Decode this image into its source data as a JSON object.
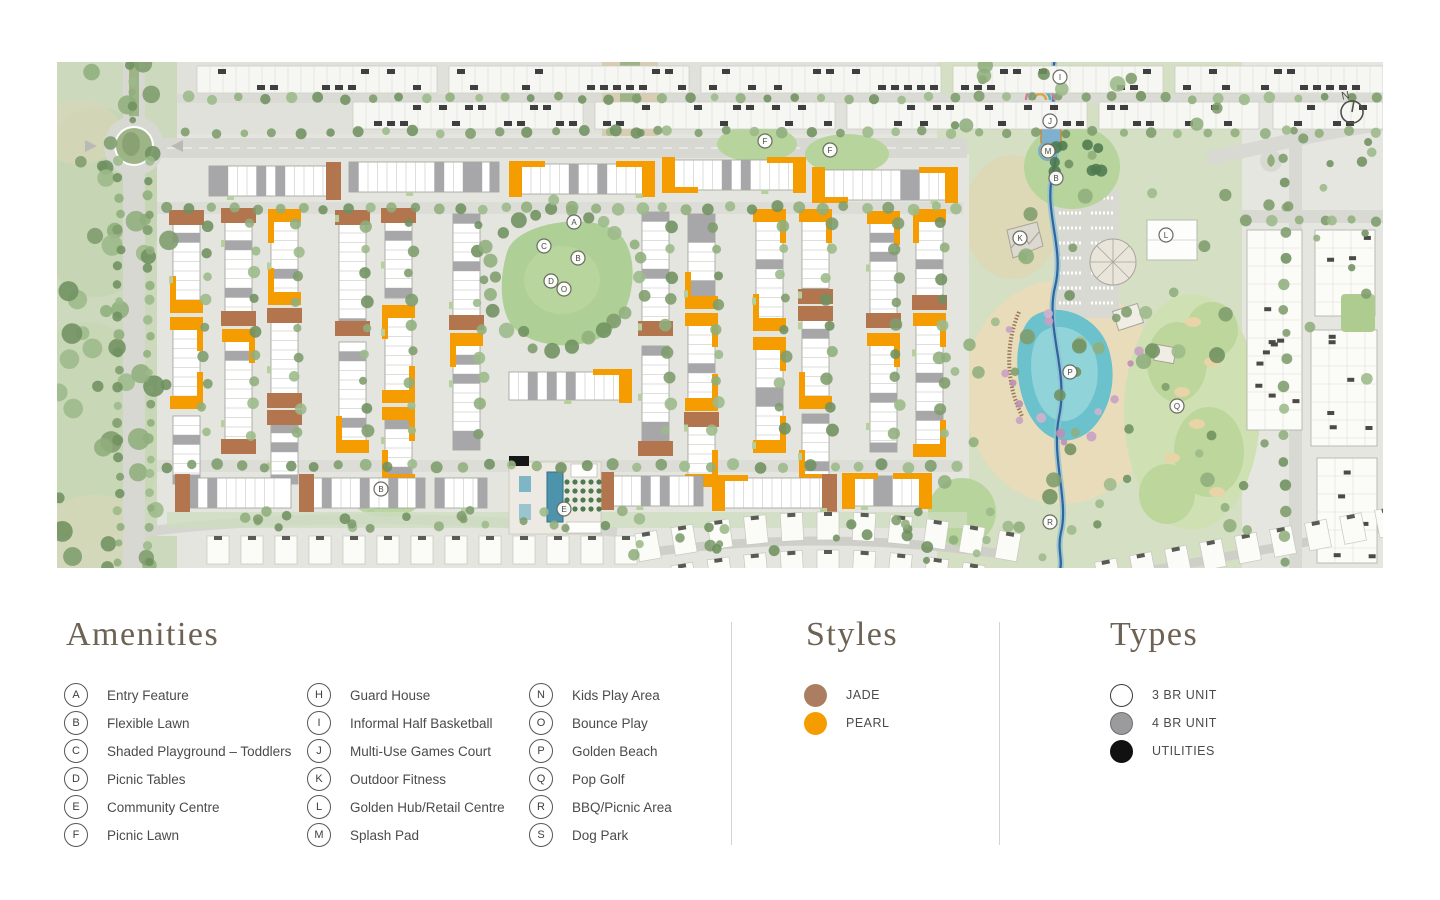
{
  "map": {
    "compass_label": "N",
    "markers": [
      {
        "letter": "A",
        "x": 517,
        "y": 160
      },
      {
        "letter": "C",
        "x": 487,
        "y": 184
      },
      {
        "letter": "B",
        "x": 521,
        "y": 196
      },
      {
        "letter": "D",
        "x": 494,
        "y": 219
      },
      {
        "letter": "O",
        "x": 507,
        "y": 227
      },
      {
        "letter": "F",
        "x": 708,
        "y": 79
      },
      {
        "letter": "F",
        "x": 773,
        "y": 88
      },
      {
        "letter": "E",
        "x": 507,
        "y": 447
      },
      {
        "letter": "B",
        "x": 324,
        "y": 427
      },
      {
        "letter": "I",
        "x": 1003,
        "y": 15
      },
      {
        "letter": "J",
        "x": 993,
        "y": 59
      },
      {
        "letter": "M",
        "x": 991,
        "y": 89
      },
      {
        "letter": "B",
        "x": 999,
        "y": 116
      },
      {
        "letter": "K",
        "x": 963,
        "y": 176
      },
      {
        "letter": "L",
        "x": 1109,
        "y": 173
      },
      {
        "letter": "P",
        "x": 1013,
        "y": 310
      },
      {
        "letter": "Q",
        "x": 1120,
        "y": 344
      },
      {
        "letter": "R",
        "x": 993,
        "y": 460
      }
    ],
    "colors": {
      "pearl": "#F59C00",
      "jade": "#B3754E",
      "paving": "#E4E5DF",
      "road": "#D7D8D2",
      "nature": "#CCD9BC",
      "park_green": "#AED096",
      "lawn": "#B7D49C",
      "sand": "#E9DCBA",
      "lagoon": "#6BC2CC",
      "lagoon_light": "#A5DBE0",
      "stream": "#2F64A0",
      "tree": "#7E9C6C",
      "pink_tree": "#C9A0C4",
      "unit_white": "#FFFFFF",
      "unit_gray": "#A7A7A9",
      "utilities": "#161616",
      "neighbor": "#F6F6F2"
    }
  },
  "legend": {
    "amenities": {
      "title": "Amenities",
      "items": [
        {
          "letter": "A",
          "label": "Entry Feature"
        },
        {
          "letter": "B",
          "label": "Flexible Lawn"
        },
        {
          "letter": "C",
          "label": "Shaded Playground – Toddlers"
        },
        {
          "letter": "D",
          "label": "Picnic Tables"
        },
        {
          "letter": "E",
          "label": "Community Centre"
        },
        {
          "letter": "F",
          "label": "Picnic Lawn"
        },
        {
          "letter": "H",
          "label": "Guard House"
        },
        {
          "letter": "I",
          "label": "Informal Half Basketball"
        },
        {
          "letter": "J",
          "label": "Multi-Use Games Court"
        },
        {
          "letter": "K",
          "label": "Outdoor Fitness"
        },
        {
          "letter": "L",
          "label": "Golden Hub/Retail Centre"
        },
        {
          "letter": "M",
          "label": "Splash Pad"
        },
        {
          "letter": "N",
          "label": "Kids Play Area"
        },
        {
          "letter": "O",
          "label": "Bounce Play"
        },
        {
          "letter": "P",
          "label": "Golden Beach"
        },
        {
          "letter": "Q",
          "label": "Pop Golf"
        },
        {
          "letter": "R",
          "label": "BBQ/Picnic Area"
        },
        {
          "letter": "S",
          "label": "Dog Park"
        }
      ]
    },
    "styles": {
      "title": "Styles",
      "items": [
        {
          "label": "JADE",
          "color": "#AC7E61"
        },
        {
          "label": "PEARL",
          "color": "#F59C00"
        }
      ]
    },
    "types": {
      "title": "Types",
      "items": [
        {
          "label": "3 BR UNIT",
          "fill": "#FFFFFF",
          "stroke": "#3A3A3A"
        },
        {
          "label": "4 BR UNIT",
          "fill": "#9B9B9D",
          "stroke": "#6E6E70"
        },
        {
          "label": "UTILITIES",
          "fill": "#111111",
          "stroke": "#111111"
        }
      ]
    }
  }
}
